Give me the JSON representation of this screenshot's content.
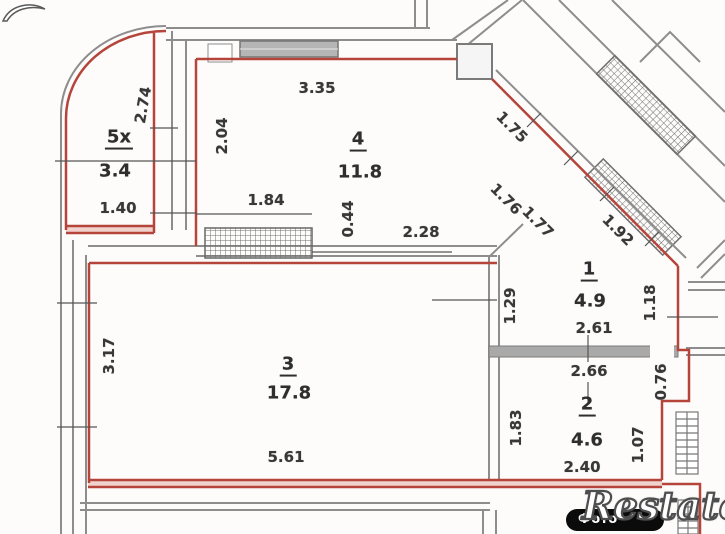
{
  "watermark": {
    "badge_text": "Фото",
    "logo_text": "Restate"
  },
  "rooms": [
    {
      "number": "5х",
      "area": "3.4"
    },
    {
      "number": "4",
      "area": "11.8"
    },
    {
      "number": "1",
      "area": "4.9"
    },
    {
      "number": "2",
      "area": "4.6"
    },
    {
      "number": "3",
      "area": "17.8"
    }
  ],
  "dimensions": {
    "horizontal": [
      "3.35",
      "1.84",
      "2.28",
      "1.40",
      "2.61",
      "2.66",
      "2.40",
      "5.61"
    ],
    "vertical": [
      "2.74",
      "2.04",
      "0.44",
      "3.17",
      "1.29",
      "1.18",
      "0.76",
      "1.83",
      "1.07"
    ],
    "diagonal": [
      "1.75",
      "1.76",
      "1.77",
      "1.92"
    ]
  },
  "colors": {
    "apartment_outline": "#b5443b",
    "walls_gray": "#8d8d8d",
    "wall_fill_pink": "#f0d3cd",
    "text": "#2e2e2e",
    "badge_bg": "#0b0b0b"
  }
}
